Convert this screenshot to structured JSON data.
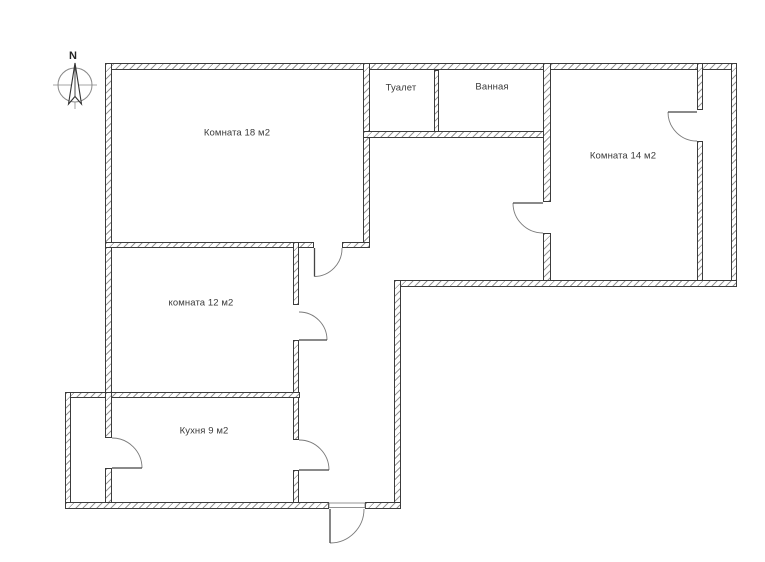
{
  "page": {
    "background": "#ffffff"
  },
  "compass": {
    "north_label": "N"
  },
  "rooms": {
    "room18": {
      "label": "Комната 18 м2"
    },
    "toilet": {
      "label": "Туалет"
    },
    "bathroom": {
      "label": "Ванная"
    },
    "room14": {
      "label": "Комната 14 м2"
    },
    "room12": {
      "label": "комната 12 м2"
    },
    "kitchen": {
      "label": "Кухня 9 м2"
    }
  },
  "colors": {
    "wall_outline": "#3c3c3c",
    "wall_hatch": "#919191",
    "door_arc": "#7a7a7a",
    "door_leaf": "#444444",
    "label_text": "#3a3a3a",
    "compass_line": "#888888"
  }
}
